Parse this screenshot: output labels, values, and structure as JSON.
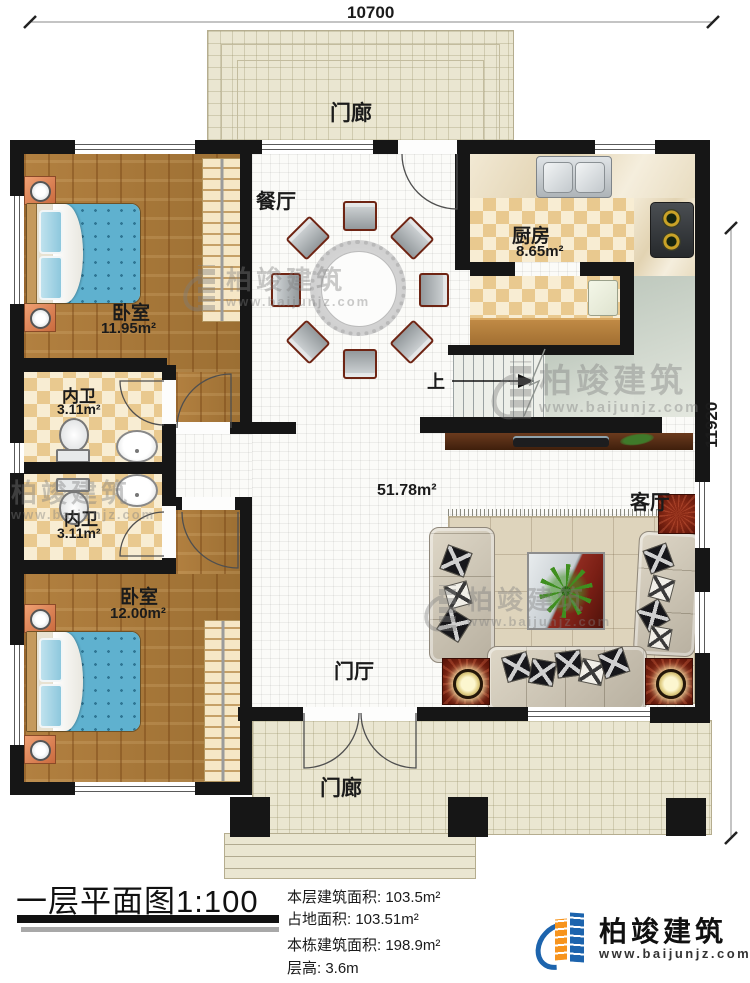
{
  "dimensions": {
    "top": "10700",
    "right": "11920"
  },
  "rooms": {
    "porch_top": {
      "label": "门廊"
    },
    "dining": {
      "label": "餐厅"
    },
    "kitchen": {
      "label": "厨房",
      "area": "8.65m²"
    },
    "bedroom1": {
      "label": "卧室",
      "area": "11.95m²"
    },
    "bath1": {
      "label": "内卫",
      "area": "3.11m²"
    },
    "bath2": {
      "label": "内卫",
      "area": "3.11m²"
    },
    "bedroom2": {
      "label": "卧室",
      "area": "12.00m²"
    },
    "living": {
      "label": "客厅"
    },
    "hall": {
      "area": "51.78m²"
    },
    "foyer": {
      "label": "门厅"
    },
    "porch_bottom": {
      "label": "门廊"
    },
    "stairs": {
      "up_label": "上"
    }
  },
  "title_block": {
    "title": "一层平面图1:100",
    "stats": [
      "本层建筑面积: 103.5m²",
      "占地面积: 103.51m²",
      "本栋建筑面积: 198.9m²",
      "层高: 3.6m"
    ]
  },
  "branding": {
    "name": "柏竣建筑",
    "url": "www.baijunjz.com"
  },
  "watermark": {
    "name": "柏竣建筑",
    "url": "www.baijunjz.com"
  },
  "colors": {
    "wall": "#161616",
    "wood_floor": "#a87a3c",
    "tile_tan": "#e9c98f",
    "tile_cream": "#f8edd3",
    "porch": "#eae6d1",
    "bed_blue": "#5fb1cf",
    "logo_blue": "#1d64ad",
    "logo_orange": "#f7941d"
  }
}
